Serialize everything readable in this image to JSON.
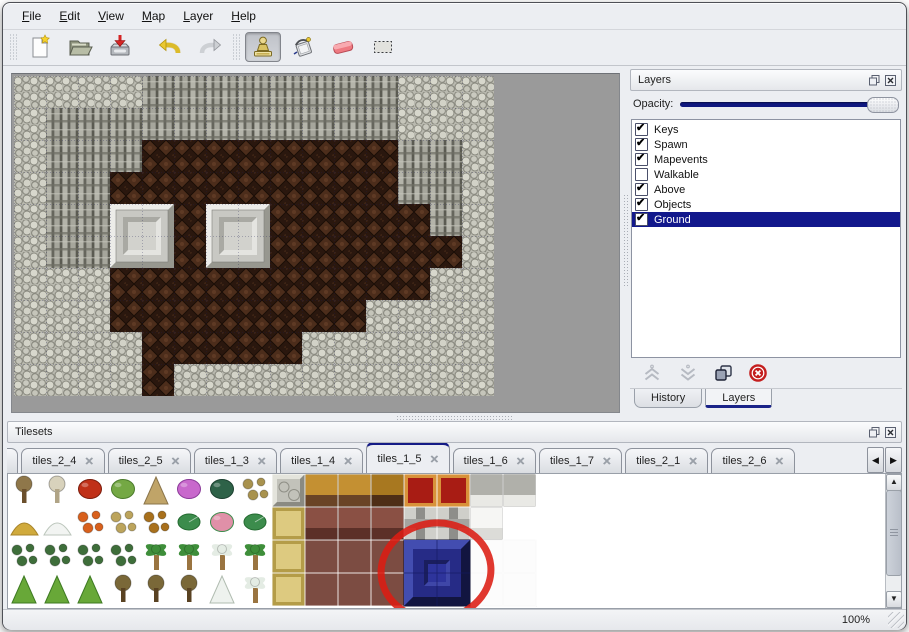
{
  "menu": {
    "items": [
      "File",
      "Edit",
      "View",
      "Map",
      "Layer",
      "Help"
    ]
  },
  "toolbar": {
    "tools": [
      "new",
      "open",
      "save",
      "undo",
      "redo",
      "stamp",
      "fill",
      "eraser",
      "select"
    ],
    "active_tool": "stamp"
  },
  "layers_panel": {
    "title": "Layers",
    "opacity_label": "Opacity:",
    "opacity_value": "100",
    "layers": [
      {
        "label": "Keys",
        "checked": true,
        "selected": false
      },
      {
        "label": "Spawn",
        "checked": true,
        "selected": false
      },
      {
        "label": "Mapevents",
        "checked": true,
        "selected": false
      },
      {
        "label": "Walkable",
        "checked": false,
        "selected": false
      },
      {
        "label": "Above",
        "checked": true,
        "selected": false
      },
      {
        "label": "Objects",
        "checked": true,
        "selected": false
      },
      {
        "label": "Ground",
        "checked": true,
        "selected": true
      }
    ],
    "buttons": [
      "raise-layer",
      "lower-layer",
      "merge-layer",
      "delete-layer"
    ],
    "tabs": [
      {
        "label": "History",
        "active": false
      },
      {
        "label": "Layers",
        "active": true
      }
    ]
  },
  "tilesets_panel": {
    "title": "Tilesets",
    "close_glyph": "✕",
    "tabs": [
      {
        "label": "3",
        "active": false,
        "cut": true
      },
      {
        "label": "tiles_2_4",
        "active": false,
        "cut": false
      },
      {
        "label": "tiles_2_5",
        "active": false,
        "cut": false
      },
      {
        "label": "tiles_1_3",
        "active": false,
        "cut": false
      },
      {
        "label": "tiles_1_4",
        "active": false,
        "cut": false
      },
      {
        "label": "tiles_1_5",
        "active": true,
        "cut": false
      },
      {
        "label": "tiles_1_6",
        "active": false,
        "cut": false
      },
      {
        "label": "tiles_1_7",
        "active": false,
        "cut": false
      },
      {
        "label": "tiles_2_1",
        "active": false,
        "cut": false
      },
      {
        "label": "tiles_2_6",
        "active": false,
        "cut": false
      }
    ],
    "nav": {
      "left": "◀",
      "right": "▶"
    }
  },
  "statusbar": {
    "zoom_level": "100%"
  },
  "map": {
    "tile_size": 32,
    "legend": {
      "P": "pebble-ground",
      "C": "cliff-wall",
      "B": "brown-floor"
    },
    "rows": [
      "PPPPCCCCCCCCPPP",
      "PCCCCCCCCCCCPPP",
      "PCCCBBBBBBBBCCP",
      "PCCBBBBBBBBBCCP",
      "PCCBBBBBBBBBBCP",
      "PCCBBBBBBBBBBBP",
      "PPPBBBBBBBBBBPP",
      "PPPBBBBBBBBPPPP",
      "PPPPBBBBBPPPPPP",
      "PPPPBPPPPPPPPPP"
    ],
    "pedestals": [
      {
        "x": 96,
        "y": 128
      },
      {
        "x": 192,
        "y": 128
      }
    ]
  },
  "palette": {
    "tile_size": 33,
    "cells": [
      [
        "tree-dead",
        "tree-white",
        "flower-red",
        "stump",
        "pillar",
        "flower-purple",
        "palm-dark",
        "plant-spider",
        "stone-cobble",
        "table-gold",
        "table-gold",
        "table-gold-edge",
        "carpet-red",
        "carpet-red",
        "stone-white",
        "stone-white"
      ],
      [
        "hay",
        "snow-pile",
        "flowers-orange",
        "grass-dry",
        "leaves",
        "lilypad",
        "roses",
        "lilypad",
        "floor-gold",
        "table-maroon",
        "table-maroon",
        "table-maroon",
        "beam-gray",
        "beam-gray",
        "cloth-white",
        "blank"
      ],
      [
        "bush-small",
        "bush-small",
        "bush-small",
        "bush-small",
        "palm-green",
        "palm-green",
        "palm-snow",
        "palm-green",
        "floor-gold",
        "maroon-flat",
        "maroon-flat",
        "maroon-flat",
        "sel",
        "sel",
        "white-tile",
        "white-tile"
      ],
      [
        "bush-cone",
        "bush-cone",
        "bush-cone",
        "tree-dark",
        "tree-dark",
        "tree-dark",
        "tree-snow",
        "palm-snow",
        "floor-gold",
        "maroon-flat",
        "maroon-flat",
        "maroon-flat",
        "sel",
        "sel",
        "white-tile",
        "white-tile"
      ]
    ],
    "styles": {
      "tree-dead": {
        "k": "tree",
        "foliage": "#8f774a",
        "trunk": "#6b4f2c"
      },
      "tree-white": {
        "k": "tree",
        "foliage": "#d8d2bc",
        "trunk": "#b0a486"
      },
      "tree-dark": {
        "k": "tree",
        "foliage": "#7a6838",
        "trunk": "#594222"
      },
      "flower-red": {
        "k": "blob",
        "c": "#c03018",
        "d": "#7a1c0c"
      },
      "stump": {
        "k": "blob",
        "c": "#74a844",
        "d": "#4a7a2a"
      },
      "pillar": {
        "k": "cone",
        "c": "#c0a468",
        "d": "#8a744a"
      },
      "flower-purple": {
        "k": "blob",
        "c": "#c868cc",
        "d": "#8a3a98"
      },
      "palm-dark": {
        "k": "blob",
        "c": "#2e6248",
        "d": "#1c4030"
      },
      "plant-spider": {
        "k": "scatter",
        "c": "#a8924e"
      },
      "stone-cobble": {
        "k": "bevel",
        "c": "#c2c2ba",
        "light": "#e4e4dc",
        "dark": "#8a8a82"
      },
      "table-gold": {
        "k": "tile2",
        "top": "#c49032",
        "front": "#6a4426"
      },
      "table-gold-edge": {
        "k": "tile2",
        "top": "#a87820",
        "front": "#4e2e16"
      },
      "carpet-red": {
        "k": "carpet",
        "c": "#a81c14",
        "b": "#d8923a"
      },
      "stone-white": {
        "k": "tile2",
        "top": "#b0b0aa",
        "front": "#e9e9e5"
      },
      "hay": {
        "k": "mound",
        "c": "#d0aa3c",
        "d": "#a8842a"
      },
      "snow-pile": {
        "k": "mound",
        "c": "#f2f4f2",
        "d": "#bcc6bc"
      },
      "flowers-orange": {
        "k": "scatter",
        "c": "#d8601c"
      },
      "grass-dry": {
        "k": "scatter",
        "c": "#bca45c"
      },
      "leaves": {
        "k": "scatter",
        "c": "#a8701c"
      },
      "lilypad": {
        "k": "pad",
        "c": "#3c8c4c",
        "d": "#236a30"
      },
      "roses": {
        "k": "blob",
        "c": "#e090a8",
        "d": "#3c8c4c"
      },
      "floor-gold": {
        "k": "carpet",
        "c": "#ddca80",
        "b": "#b49c48"
      },
      "table-maroon": {
        "k": "tile2",
        "top": "#8a5044",
        "front": "#5c3028"
      },
      "beam-gray": {
        "k": "beam",
        "c": "#cfcfca",
        "d": "#8e8e8a"
      },
      "cloth-white": {
        "k": "tile2",
        "top": "#f6f6f4",
        "front": "#dcdcd8"
      },
      "blank": {
        "k": "plain",
        "c": "#ffffff"
      },
      "bush-small": {
        "k": "scatter",
        "c": "#3e6e3a"
      },
      "palm-green": {
        "k": "palm",
        "c": "#3e8e3a",
        "trunk": "#9a7440"
      },
      "palm-snow": {
        "k": "palm",
        "c": "#e4ece4",
        "trunk": "#9a7440"
      },
      "bush-cone": {
        "k": "cone",
        "c": "#68a838",
        "d": "#3e7a22"
      },
      "tree-snow": {
        "k": "cone",
        "c": "#eef2ee",
        "d": "#b0bcb0"
      },
      "maroon-flat": {
        "k": "plain",
        "c": "#7c4c42"
      },
      "white-tile": {
        "k": "plain",
        "c": "#fcfcfc",
        "stroke": "#dcdcdc"
      },
      "sel": {
        "k": "none"
      }
    },
    "selected_tile": {
      "col": 12,
      "row": 2,
      "span": 2,
      "color": "#262b86",
      "light": "#434db0",
      "dark": "#121540"
    },
    "annotation": {
      "type": "red-circle",
      "cx": 428,
      "cy": 97,
      "rx": 55,
      "ry": 48,
      "color": "#dc1c12",
      "stroke_width": 7
    }
  },
  "colors": {
    "accent_navy": "#141b86",
    "canvas_bg": "#9a9a9a",
    "selection_red": "#dc1c12"
  }
}
